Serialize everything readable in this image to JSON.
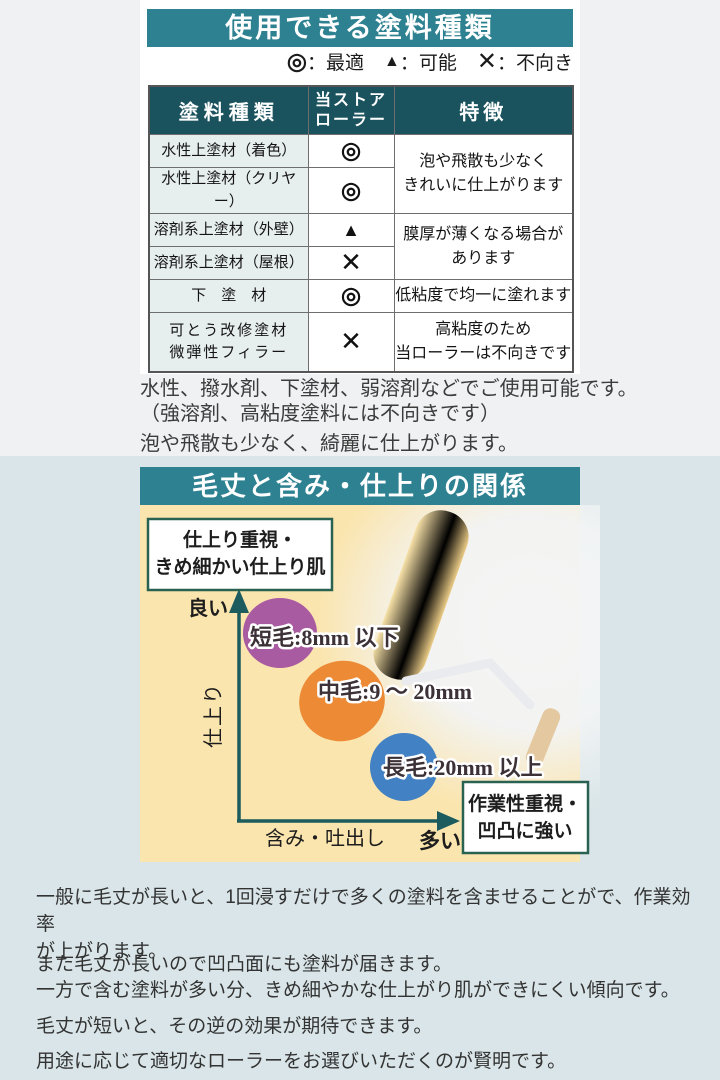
{
  "colors": {
    "header_teal": "#2e8191",
    "table_header_bg": "#1a525e",
    "type_cell_bg": "#e7eeee",
    "page_top_bg": "#eff1f2",
    "page_bottom_bg": "#d9e5e8",
    "chart_bg": "#fbe5ae",
    "axis_teal": "#1c5b5e",
    "annotation_box_border": "#2a6252",
    "bubble_purple": "#a95ba1",
    "bubble_orange": "#ec8a35",
    "bubble_blue": "#4181c4"
  },
  "section1": {
    "title": "使用できる塗料種類",
    "legend": [
      {
        "symbol": "◎",
        "label": "：最適"
      },
      {
        "symbol": "▲",
        "label": "：可能"
      },
      {
        "symbol": "✕",
        "label": "：不向き"
      }
    ],
    "table": {
      "header_type": "塗料種類",
      "header_roller_line1": "当ストア",
      "header_roller_line2": "ローラー",
      "header_feature": "特徴",
      "rows": [
        {
          "type": "水性上塗材（着色）",
          "mark": "◎"
        },
        {
          "type": "水性上塗材（クリヤー）",
          "mark": "◎"
        },
        {
          "type": "溶剤系上塗材（外壁）",
          "mark": "▲"
        },
        {
          "type": "溶剤系上塗材（屋根）",
          "mark": "✕"
        },
        {
          "type": "下　塗　材",
          "mark": "◎"
        },
        {
          "type": "可とう改修塗材\n微弾性フィラー",
          "mark": "✕"
        }
      ],
      "features": [
        "泡や飛散も少なく\nきれいに仕上がります",
        "膜厚が薄くなる場合が\nあります",
        "低粘度で均一に塗れます",
        "高粘度のため\n当ローラーは不向きです"
      ]
    },
    "notes": [
      "水性、撥水剤、下塗材、弱溶剤などでご使用可能です。",
      "（強溶剤、高粘度塗料には不向きです）",
      "泡や飛散も少なく、綺麗に仕上がります。"
    ]
  },
  "section2": {
    "title": "毛丈と含み・仕上りの関係",
    "box_top_left_line1": "仕上り重視・",
    "box_top_left_line2": "きめ細かい仕上り肌",
    "box_bottom_right_line1": "作業性重視・",
    "box_bottom_right_line2": "凹凸に強い",
    "y_good": "良い",
    "y_axis": "仕上り",
    "x_axis": "含み・吐出し",
    "x_many": "多い",
    "bubbles": [
      {
        "label": "短毛:8mm 以下"
      },
      {
        "label": "中毛:9 ～ 20mm"
      },
      {
        "label": "長毛:20mm 以上"
      }
    ],
    "paragraphs": [
      "一般に毛丈が長いと、1回浸すだけで多くの塗料を含ませることがで、作業効率\nが上がります。",
      "また毛丈が長いので凹凸面にも塗料が届きます。",
      "一方で含む塗料が多い分、きめ細やかな仕上がり肌ができにくい傾向です。",
      "毛丈が短いと、その逆の効果が期待できます。",
      "用途に応じて適切なローラーをお選びいただくのが賢明です。"
    ]
  },
  "chart_data": {
    "type": "scatter",
    "title": "毛丈と含み・仕上りの関係",
    "xlabel": "含み・吐出し（右ほど多い）",
    "ylabel": "仕上り（上ほど良い）",
    "points": [
      {
        "label": "短毛:8mm 以下",
        "capacity": 1,
        "finish": 3,
        "color": "#a95ba1"
      },
      {
        "label": "中毛:9 ～ 20mm",
        "capacity": 2,
        "finish": 2,
        "color": "#ec8a35"
      },
      {
        "label": "長毛:20mm 以上",
        "capacity": 3,
        "finish": 1,
        "color": "#4181c4"
      }
    ],
    "annotations": [
      "仕上り重視・きめ細かい仕上り肌",
      "作業性重視・凹凸に強い"
    ],
    "legend_position": "none",
    "grid": false
  }
}
